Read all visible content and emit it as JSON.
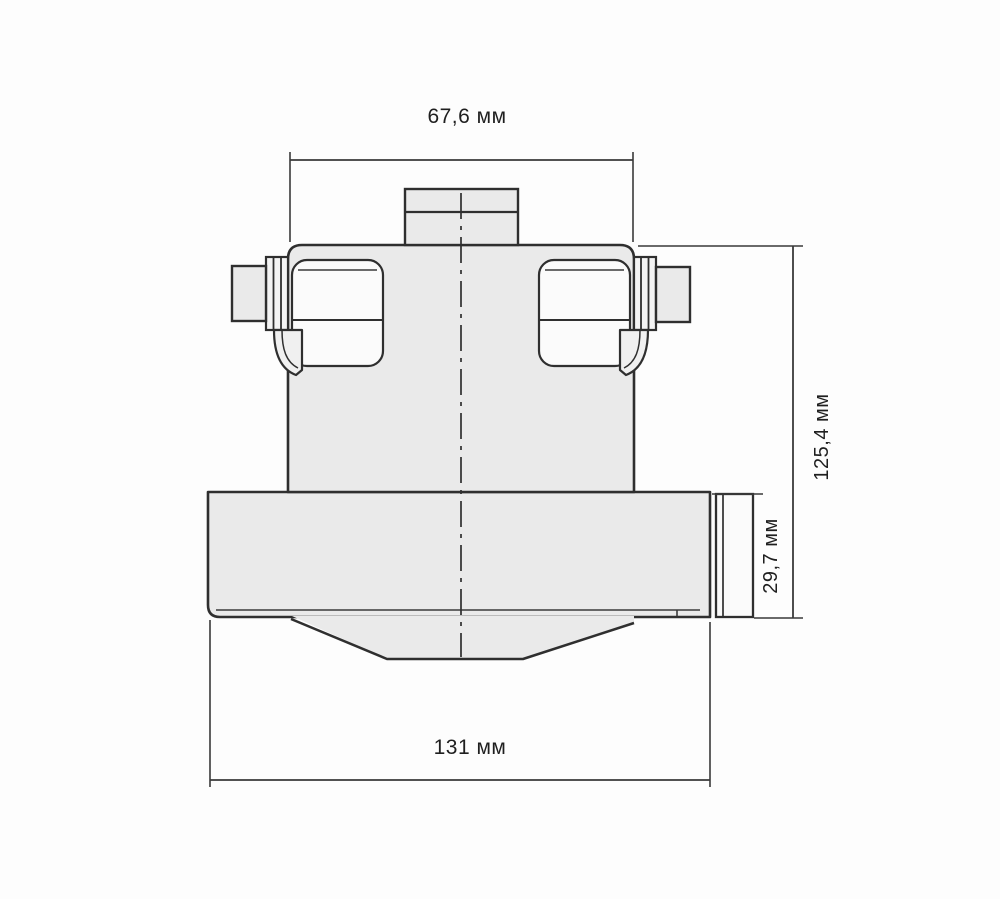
{
  "drawing": {
    "kind": "technical-dimension-drawing",
    "subject": "vacuum-cleaner-motor-front-view",
    "units": "мм",
    "dimensions": {
      "top_width": {
        "label": "67,6 мм",
        "value": 67.6,
        "unit": "мм"
      },
      "overall_height": {
        "label": "125,4 мм",
        "value": 125.4,
        "unit": "мм"
      },
      "fan_section_height": {
        "label": "29,7 мм",
        "value": 29.7,
        "unit": "мм"
      },
      "bottom_width": {
        "label": "131 мм",
        "value": 131,
        "unit": "мм"
      }
    },
    "colors": {
      "background": "#fdfdfd",
      "part_fill": "#eaeaea",
      "window_fill": "#fbfbfb",
      "outline": "#2f2f2f",
      "text": "#1f1f1f"
    }
  }
}
